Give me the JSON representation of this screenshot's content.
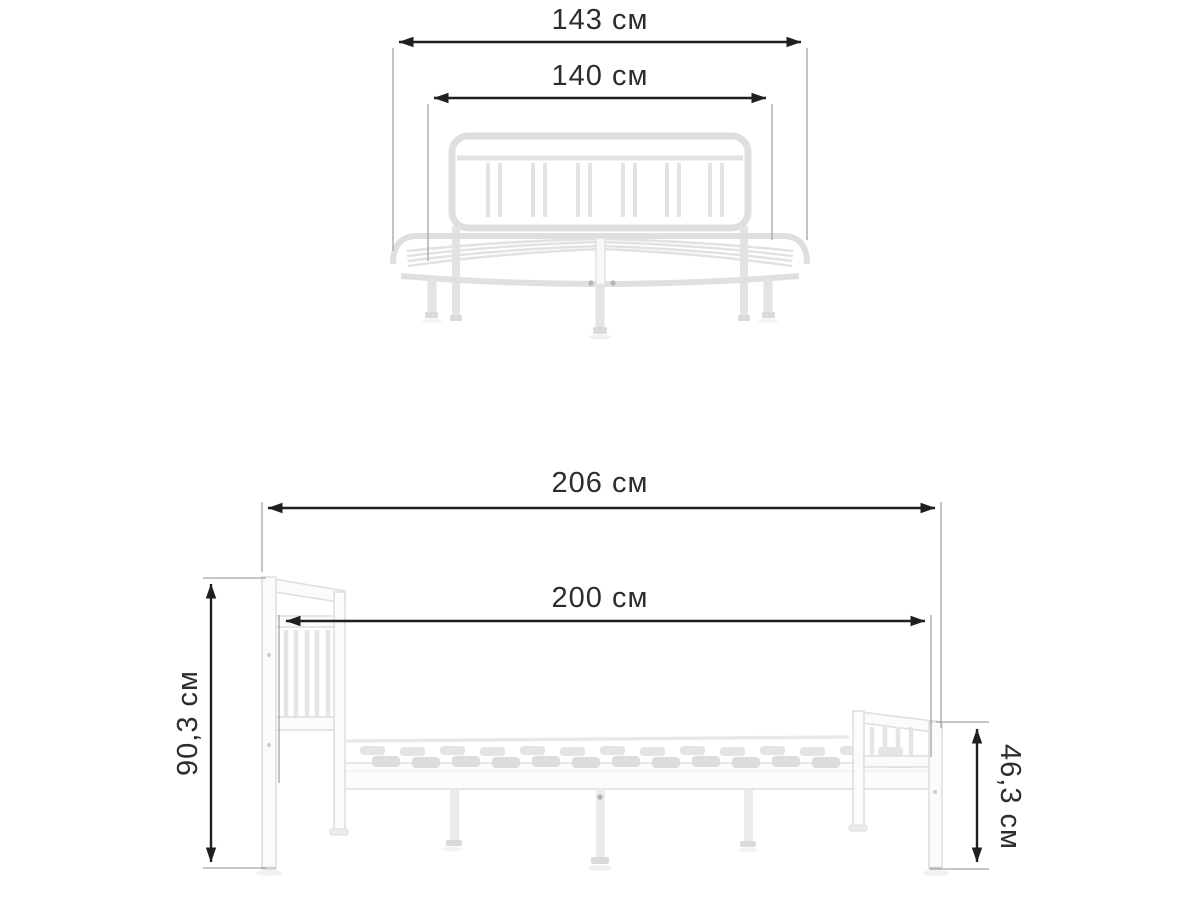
{
  "views": {
    "front": {
      "dimensions": {
        "overall_width": "143 см",
        "mattress_width": "140 см"
      }
    },
    "side": {
      "dimensions": {
        "overall_length": "206 см",
        "mattress_length": "200 см",
        "headboard_height": "90,3 см",
        "footboard_height": "46,3 см"
      }
    }
  },
  "colors": {
    "background": "#ffffff",
    "dimension_line": "#1f1f1f",
    "extension_line": "#a3a3a3",
    "label_text": "#2d2d2d",
    "bed_outline": "#dedede",
    "bed_fill": "#fbfbfb",
    "slat_fill": "#dcdcdc"
  }
}
